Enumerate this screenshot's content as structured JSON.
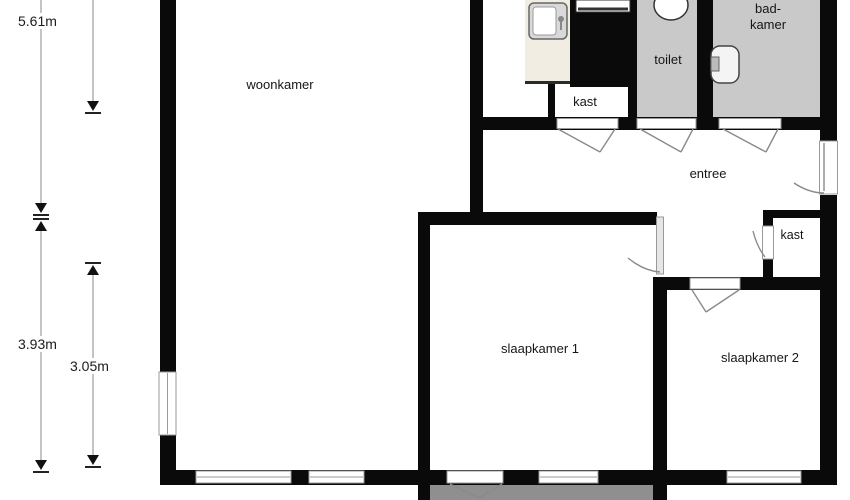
{
  "floorplan": {
    "rooms": {
      "woonkamer": {
        "label": "woonkamer"
      },
      "kast_top": {
        "label": "kast"
      },
      "toilet": {
        "label": "toilet"
      },
      "badkamer": {
        "label_line1": "bad-",
        "label_line2": "kamer"
      },
      "entree": {
        "label": "entree"
      },
      "kast_hal": {
        "label": "kast"
      },
      "slaapkamer1": {
        "label": "slaapkamer 1"
      },
      "slaapkamer2": {
        "label": "slaapkamer 2"
      }
    },
    "dimensions": {
      "outer_top": "5.61m",
      "outer_bottom": "3.93m",
      "inner_bottom": "3.05m"
    },
    "colors": {
      "wall": "#0a0a0a",
      "wet_room_floor": "#c9c9c9",
      "balcony_floor": "#8f8f8f",
      "kitchen_counter": "#f1ede2"
    },
    "icons": [
      "kitchen-sink-icon",
      "stove-icon",
      "toilet-bowl-icon",
      "wash-basin-icon"
    ]
  }
}
